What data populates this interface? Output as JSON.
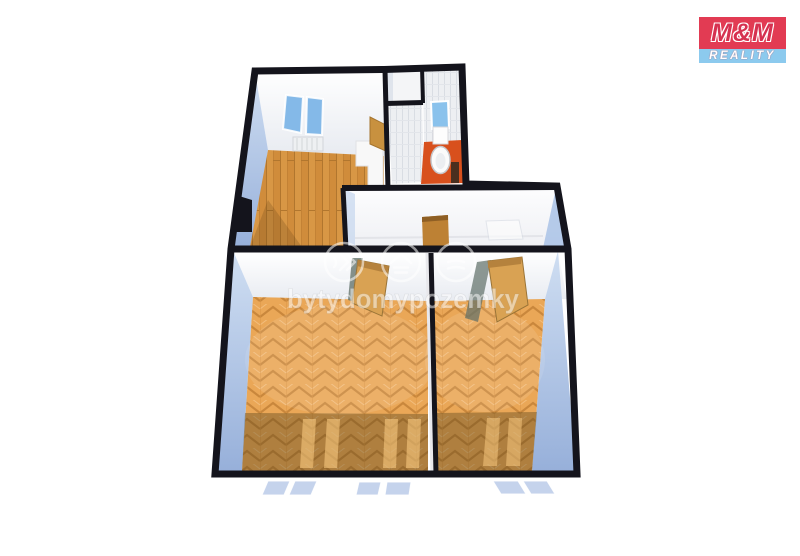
{
  "branding": {
    "name": "M&M Reality",
    "logo_top": "M&M",
    "logo_bottom": "REALITY",
    "colors": {
      "red": "#e23b53",
      "blue": "#8ccaee",
      "text": "#ffffff"
    }
  },
  "watermark": {
    "text": "bytydomypozemky",
    "icons": [
      "sound-waves-icon",
      "house-icon",
      "layers-icon"
    ],
    "color": "#ffffff",
    "opacity": 0.5
  },
  "floor_plan": {
    "view": "3d-top-down-perspective",
    "background": "#ffffff",
    "wall_color": "#14141c",
    "side_wall_color": "#a9c2e6",
    "window_glass_color": "#84b9e8",
    "rooms": [
      {
        "id": "kitchen",
        "position": "top-left",
        "floor": "wood-planks",
        "floor_color": "#d89745",
        "features": [
          "window",
          "window",
          "radiator",
          "counter",
          "door",
          "chimney-notch"
        ]
      },
      {
        "id": "closet",
        "position": "top-center",
        "floor_color": "#f4f5f7",
        "features": []
      },
      {
        "id": "wc",
        "position": "top-right",
        "floor": "tile",
        "floor_color": "#d8501d",
        "features": [
          "window",
          "cistern",
          "toilet",
          "waste-bin"
        ]
      },
      {
        "id": "hallway",
        "position": "middle",
        "floor_color": "#f4f4f7",
        "features": [
          "entry-door",
          "mat"
        ]
      },
      {
        "id": "room-left",
        "position": "bottom-left",
        "floor": "herringbone-parquet",
        "floor_color": "#eaa757",
        "features": [
          "open-door",
          "window-light-pair",
          "window-light-pair"
        ]
      },
      {
        "id": "room-right",
        "position": "bottom-right",
        "floor": "herringbone-parquet",
        "floor_color": "#eaa757",
        "features": [
          "open-door",
          "window-light-pair"
        ]
      }
    ],
    "exterior_windows": 6
  }
}
